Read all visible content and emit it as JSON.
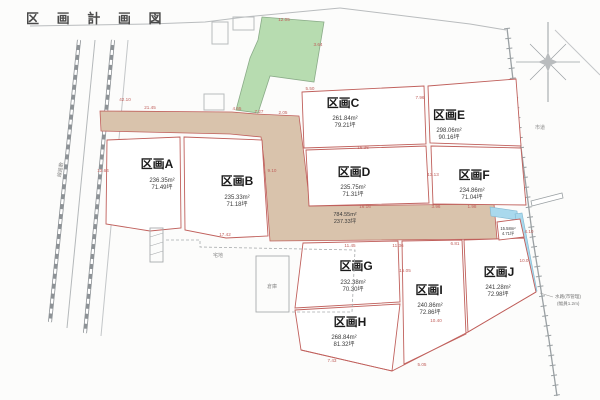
{
  "title": "区 画 計 画 図",
  "map": {
    "plots": [
      {
        "id": "A",
        "label": "区画A",
        "area_m2": "236.35m²",
        "area_tsubo": "71.49坪"
      },
      {
        "id": "B",
        "label": "区画B",
        "area_m2": "235.33m²",
        "area_tsubo": "71.18坪"
      },
      {
        "id": "C",
        "label": "区画C",
        "area_m2": "261.84m²",
        "area_tsubo": "79.21坪"
      },
      {
        "id": "D",
        "label": "区画D",
        "area_m2": "235.75m²",
        "area_tsubo": "71.31坪"
      },
      {
        "id": "E",
        "label": "区画E",
        "area_m2": "298.06m²",
        "area_tsubo": "90.16坪"
      },
      {
        "id": "F",
        "label": "区画F",
        "area_m2": "234.86m²",
        "area_tsubo": "71.04坪"
      },
      {
        "id": "G",
        "label": "区画G",
        "area_m2": "232.38m²",
        "area_tsubo": "70.30坪"
      },
      {
        "id": "H",
        "label": "区画H",
        "area_m2": "268.84m²",
        "area_tsubo": "81.32坪"
      },
      {
        "id": "I",
        "label": "区画I",
        "area_m2": "240.86m²",
        "area_tsubo": "72.86坪"
      },
      {
        "id": "J",
        "label": "区画J",
        "area_m2": "241.28m²",
        "area_tsubo": "72.98坪"
      }
    ],
    "road": {
      "area_m2": "784.55m²",
      "area_tsubo": "237.33坪"
    },
    "sliver": {
      "area_m2": "15.58m²",
      "area_tsubo": "4.71坪"
    },
    "annotations": {
      "city_road": "市道",
      "water_note1": "水路(市管理)",
      "water_note2": "(幅員1.2m)",
      "rail_note": "線路敷",
      "parcel_note": "宅地",
      "shed_note": "倉庫"
    },
    "dims": [
      "21.45",
      "4.55",
      "7.27",
      "2.05",
      "5.50",
      "7.96",
      "16.36",
      "13.13",
      "16.16",
      "3.96",
      "1.98",
      "11.45",
      "11.36",
      "6.81",
      "4.10",
      "15.05",
      "10.40",
      "7.43",
      "5.05",
      "10.0",
      "17.42",
      "9.10",
      "13.64",
      "42.10",
      "3.64",
      "12.05"
    ],
    "colors": {
      "road_fill": "#d9c3ac",
      "green_fill": "#b7dcb0",
      "water_fill": "#a9d9ed",
      "boundary_red": "#c0605c",
      "line_gray": "#9aa0a3"
    }
  }
}
